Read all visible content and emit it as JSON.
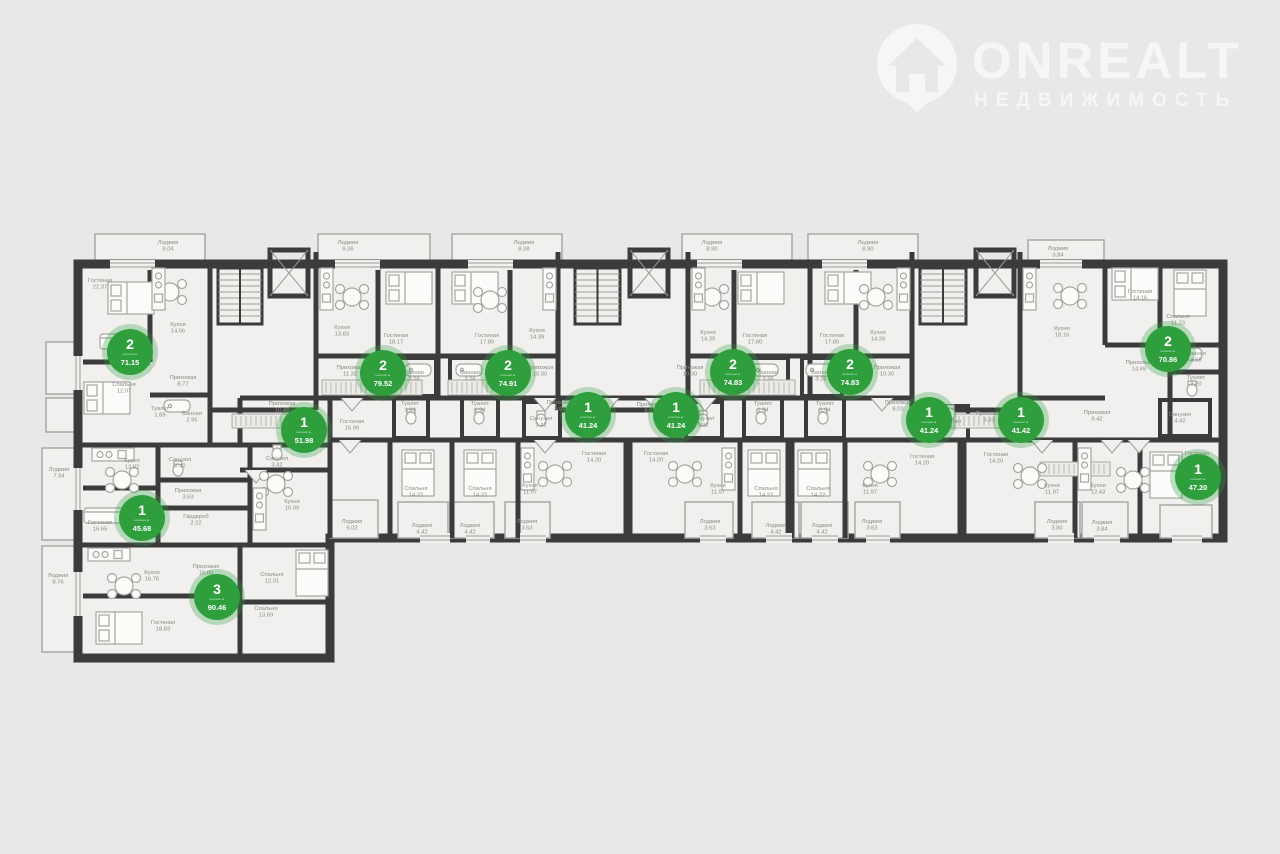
{
  "watermark": {
    "brand": "ONREALT",
    "tagline": "НЕДВИЖИМОСТЬ"
  },
  "badge_unit_label": "комнаты",
  "palette": {
    "background": "#e8e8e8",
    "floor": "#f1f0ee",
    "wall": "#3b3b3b",
    "badge_green": "#2f9f3e",
    "label_gray": "#8a8a85"
  },
  "apartments": [
    {
      "rooms": "2",
      "area": "71.15",
      "x": 130,
      "y": 352
    },
    {
      "rooms": "2",
      "area": "79.52",
      "x": 383,
      "y": 373
    },
    {
      "rooms": "2",
      "area": "74.91",
      "x": 508,
      "y": 373
    },
    {
      "rooms": "2",
      "area": "74.83",
      "x": 733,
      "y": 372
    },
    {
      "rooms": "2",
      "area": "74.83",
      "x": 850,
      "y": 372
    },
    {
      "rooms": "2",
      "area": "70.86",
      "x": 1168,
      "y": 349
    },
    {
      "rooms": "1",
      "area": "51.98",
      "x": 304,
      "y": 430
    },
    {
      "rooms": "1",
      "area": "41.24",
      "x": 588,
      "y": 415
    },
    {
      "rooms": "1",
      "area": "41.24",
      "x": 676,
      "y": 415
    },
    {
      "rooms": "1",
      "area": "41.24",
      "x": 929,
      "y": 420
    },
    {
      "rooms": "1",
      "area": "41.42",
      "x": 1021,
      "y": 420
    },
    {
      "rooms": "1",
      "area": "47.20",
      "x": 1198,
      "y": 477
    },
    {
      "rooms": "1",
      "area": "45.68",
      "x": 142,
      "y": 518
    },
    {
      "rooms": "3",
      "area": "90.46",
      "x": 217,
      "y": 597
    }
  ],
  "room_labels": [
    {
      "name": "Лоджия",
      "area": "9.04",
      "x": 168,
      "y": 244
    },
    {
      "name": "Лоджия",
      "area": "9.36",
      "x": 348,
      "y": 244
    },
    {
      "name": "Лоджия",
      "area": "8.38",
      "x": 524,
      "y": 244
    },
    {
      "name": "Лоджия",
      "area": "8.90",
      "x": 712,
      "y": 244
    },
    {
      "name": "Лоджия",
      "area": "8.90",
      "x": 868,
      "y": 244
    },
    {
      "name": "Лоджия",
      "area": "3.84",
      "x": 1058,
      "y": 250
    },
    {
      "name": "Гостиная",
      "area": "22.37",
      "x": 100,
      "y": 282
    },
    {
      "name": "Кухня",
      "area": "14.06",
      "x": 178,
      "y": 326
    },
    {
      "name": "Прихожая",
      "area": "8.77",
      "x": 183,
      "y": 379
    },
    {
      "name": "Спальня",
      "area": "12.07",
      "x": 124,
      "y": 386
    },
    {
      "name": "Туалет",
      "area": "1.89",
      "x": 160,
      "y": 410
    },
    {
      "name": "Ванная",
      "area": "2.95",
      "x": 192,
      "y": 415
    },
    {
      "name": "Кухня",
      "area": "13.83",
      "x": 342,
      "y": 329
    },
    {
      "name": "Гостиная",
      "area": "18.17",
      "x": 396,
      "y": 337
    },
    {
      "name": "Прихожая",
      "area": "11.32",
      "x": 350,
      "y": 369
    },
    {
      "name": "Ванная",
      "area": "3.28",
      "x": 414,
      "y": 374
    },
    {
      "name": "Туалет",
      "area": "1.94",
      "x": 410,
      "y": 405
    },
    {
      "name": "Гостиная",
      "area": "16.99",
      "x": 352,
      "y": 423
    },
    {
      "name": "Лоджия",
      "area": "6.02",
      "x": 352,
      "y": 523
    },
    {
      "name": "Гостиная",
      "area": "17.80",
      "x": 487,
      "y": 337
    },
    {
      "name": "Кухня",
      "area": "14.39",
      "x": 537,
      "y": 332
    },
    {
      "name": "Ванная",
      "area": "3.26",
      "x": 470,
      "y": 374
    },
    {
      "name": "Туалет",
      "area": "1.94",
      "x": 480,
      "y": 405
    },
    {
      "name": "Прихожая",
      "area": "10.30",
      "x": 540,
      "y": 369
    },
    {
      "name": "Спальня",
      "area": "14.22",
      "x": 416,
      "y": 490
    },
    {
      "name": "Спальня",
      "area": "14.22",
      "x": 480,
      "y": 490
    },
    {
      "name": "Лоджия",
      "area": "4.42",
      "x": 422,
      "y": 527
    },
    {
      "name": "Лоджия",
      "area": "4.42",
      "x": 470,
      "y": 527
    },
    {
      "name": "Прихожая",
      "area": "8.03",
      "x": 560,
      "y": 404
    },
    {
      "name": "Санузел",
      "area": "3.42",
      "x": 541,
      "y": 420
    },
    {
      "name": "Гостиная",
      "area": "14.20",
      "x": 594,
      "y": 455
    },
    {
      "name": "Кухня",
      "area": "11.97",
      "x": 530,
      "y": 487
    },
    {
      "name": "Лоджия",
      "area": "3.63",
      "x": 527,
      "y": 523
    },
    {
      "name": "Прихожая",
      "area": "8.03",
      "x": 650,
      "y": 406
    },
    {
      "name": "Санузел",
      "area": "3.42",
      "x": 703,
      "y": 420
    },
    {
      "name": "Гостиная",
      "area": "14.20",
      "x": 656,
      "y": 455
    },
    {
      "name": "Кухня",
      "area": "11.97",
      "x": 718,
      "y": 487
    },
    {
      "name": "Лоджия",
      "area": "3.63",
      "x": 710,
      "y": 523
    },
    {
      "name": "Прихожая",
      "area": "10.30",
      "x": 690,
      "y": 369
    },
    {
      "name": "Кухня",
      "area": "14.39",
      "x": 708,
      "y": 334
    },
    {
      "name": "Гостиная",
      "area": "17.80",
      "x": 755,
      "y": 337
    },
    {
      "name": "Ванная",
      "area": "3.26",
      "x": 768,
      "y": 374
    },
    {
      "name": "Туалет",
      "area": "1.94",
      "x": 763,
      "y": 405
    },
    {
      "name": "Спальня",
      "area": "14.22",
      "x": 766,
      "y": 490
    },
    {
      "name": "Лоджия",
      "area": "4.42",
      "x": 776,
      "y": 527
    },
    {
      "name": "Гостиная",
      "area": "17.80",
      "x": 832,
      "y": 337
    },
    {
      "name": "Кухня",
      "area": "14.39",
      "x": 878,
      "y": 334
    },
    {
      "name": "Ванная",
      "area": "3.26",
      "x": 821,
      "y": 374
    },
    {
      "name": "Туалет",
      "area": "1.94",
      "x": 825,
      "y": 405
    },
    {
      "name": "Прихожая",
      "area": "10.30",
      "x": 887,
      "y": 369
    },
    {
      "name": "Спальня",
      "area": "14.22",
      "x": 818,
      "y": 490
    },
    {
      "name": "Лоджия",
      "area": "4.42",
      "x": 822,
      "y": 527
    },
    {
      "name": "Прихожая",
      "area": "8.03",
      "x": 898,
      "y": 404
    },
    {
      "name": "Санузел",
      "area": "3.42",
      "x": 950,
      "y": 423
    },
    {
      "name": "Гостиная",
      "area": "14.20",
      "x": 922,
      "y": 458
    },
    {
      "name": "Кухня",
      "area": "11.97",
      "x": 870,
      "y": 487
    },
    {
      "name": "Лоджия",
      "area": "3.63",
      "x": 872,
      "y": 523
    },
    {
      "name": "Прихожая",
      "area": "8.33",
      "x": 989,
      "y": 415
    },
    {
      "name": "Гостиная",
      "area": "14.20",
      "x": 996,
      "y": 456
    },
    {
      "name": "Кухня",
      "area": "11.97",
      "x": 1052,
      "y": 487
    },
    {
      "name": "Лоджия",
      "area": "3.80",
      "x": 1057,
      "y": 523
    },
    {
      "name": "Прихожая",
      "area": "9.42",
      "x": 1097,
      "y": 414
    },
    {
      "name": "Санузел",
      "area": "4.42",
      "x": 1180,
      "y": 416
    },
    {
      "name": "Кухня",
      "area": "12.43",
      "x": 1098,
      "y": 487
    },
    {
      "name": "Гостиная",
      "area": "17.06",
      "x": 1197,
      "y": 455
    },
    {
      "name": "Лоджия",
      "area": "3.84",
      "x": 1102,
      "y": 524
    },
    {
      "name": "Кухня",
      "area": "18.16",
      "x": 1062,
      "y": 330
    },
    {
      "name": "Гостиная",
      "area": "14.16",
      "x": 1140,
      "y": 293
    },
    {
      "name": "Спальня",
      "area": "11.23",
      "x": 1178,
      "y": 318
    },
    {
      "name": "Прихожая",
      "area": "14.69",
      "x": 1139,
      "y": 364
    },
    {
      "name": "Ванная",
      "area": "3.58",
      "x": 1196,
      "y": 355
    },
    {
      "name": "Туалет",
      "area": "2.20",
      "x": 1196,
      "y": 379
    },
    {
      "name": "Лоджия",
      "area": "7.94",
      "x": 59,
      "y": 471
    },
    {
      "name": "Кухня",
      "area": "13.82",
      "x": 132,
      "y": 462
    },
    {
      "name": "Санузел",
      "area": "3.42",
      "x": 180,
      "y": 461
    },
    {
      "name": "Прихожая",
      "area": "3.63",
      "x": 188,
      "y": 492
    },
    {
      "name": "Гостиная",
      "area": "16.65",
      "x": 100,
      "y": 524
    },
    {
      "name": "Гардероб",
      "area": "2.22",
      "x": 196,
      "y": 518
    },
    {
      "name": "Прихожая",
      "area": "10.46",
      "x": 282,
      "y": 405
    },
    {
      "name": "Санузел",
      "area": "3.42",
      "x": 277,
      "y": 460
    },
    {
      "name": "Кухня",
      "area": "15.09",
      "x": 292,
      "y": 503
    },
    {
      "name": "Лоджия",
      "area": "8.76",
      "x": 58,
      "y": 577
    },
    {
      "name": "Кухня",
      "area": "16.76",
      "x": 152,
      "y": 574
    },
    {
      "name": "Прихожая",
      "area": "15.00",
      "x": 206,
      "y": 568
    },
    {
      "name": "Спальня",
      "area": "12.01",
      "x": 272,
      "y": 576
    },
    {
      "name": "Гостиная",
      "area": "18.83",
      "x": 163,
      "y": 624
    },
    {
      "name": "Спальня",
      "area": "13.69",
      "x": 266,
      "y": 610
    }
  ]
}
